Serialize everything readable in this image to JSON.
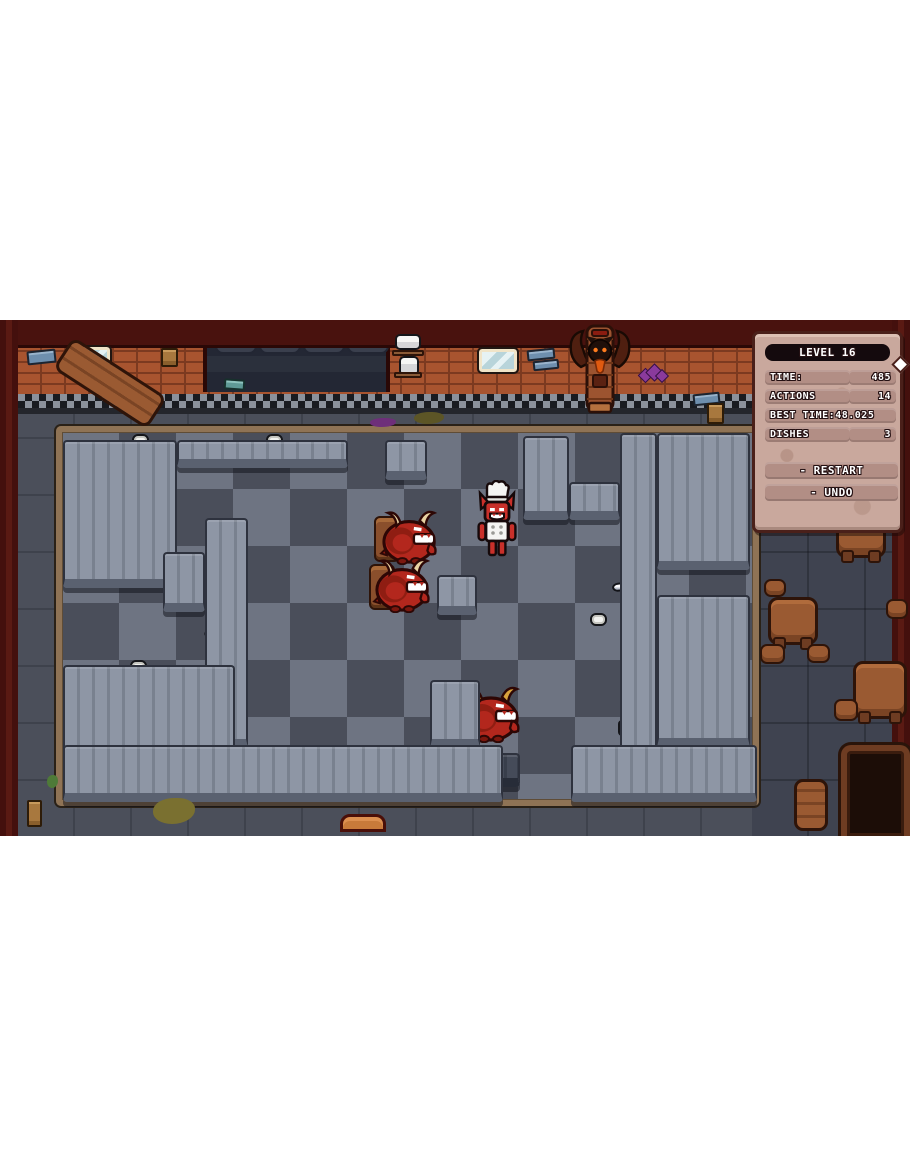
{
  "hud": {
    "level_label": "LEVEL 16",
    "rows": [
      {
        "label": "TIME:",
        "value": "485"
      },
      {
        "label": "ACTIONS",
        "value": "14"
      },
      {
        "label": "BEST TIME:",
        "value": "48.025",
        "wide": true
      },
      {
        "label": "DISHES",
        "value": "3"
      }
    ],
    "buttons": [
      {
        "label": "- RESTART",
        "name": "restart-button"
      },
      {
        "label": "- UNDO",
        "name": "undo-button"
      }
    ]
  },
  "colors": {
    "panel": "#c9a89d",
    "panel_pill": "#b28e85",
    "level_bar": "#140a0d",
    "counter": "#8e96a5",
    "kitchen_floor_dark": "#4a4e5a",
    "kitchen_floor_light": "#6e7482",
    "brick": "#a8542f",
    "wall_trim_dark": "#191b20",
    "wall_trim_light": "#8b919b",
    "demon_red": "#b3271d",
    "chef_red": "#c9302a",
    "wood": "#9a5a32",
    "accent_orange": "#e09434"
  },
  "scene": {
    "entities": [
      {
        "t": "counter",
        "x": 63,
        "y": 120,
        "w": 114,
        "h": 148
      },
      {
        "t": "counter",
        "x": 177,
        "y": 120,
        "w": 171,
        "h": 28
      },
      {
        "t": "counter",
        "x": 385,
        "y": 120,
        "w": 42,
        "h": 40
      },
      {
        "t": "counter",
        "x": 523,
        "y": 116,
        "w": 46,
        "h": 84
      },
      {
        "t": "counter",
        "x": 569,
        "y": 162,
        "w": 51,
        "h": 38
      },
      {
        "t": "counter",
        "x": 620,
        "y": 113,
        "w": 37,
        "h": 352
      },
      {
        "t": "counter",
        "x": 657,
        "y": 113,
        "w": 93,
        "h": 137
      },
      {
        "t": "counter",
        "x": 657,
        "y": 275,
        "w": 93,
        "h": 152
      },
      {
        "t": "counter",
        "x": 63,
        "y": 345,
        "w": 172,
        "h": 122
      },
      {
        "t": "counter",
        "x": 205,
        "y": 198,
        "w": 43,
        "h": 230
      },
      {
        "t": "counter",
        "x": 163,
        "y": 232,
        "w": 42,
        "h": 60
      },
      {
        "t": "counter",
        "x": 437,
        "y": 255,
        "w": 40,
        "h": 40
      },
      {
        "t": "counter",
        "x": 430,
        "y": 360,
        "w": 50,
        "h": 68
      },
      {
        "t": "counter",
        "x": 63,
        "y": 425,
        "w": 440,
        "h": 57
      },
      {
        "t": "counter",
        "x": 571,
        "y": 425,
        "w": 186,
        "h": 57
      },
      {
        "t": "counter",
        "x": 479,
        "y": 433,
        "w": 41,
        "h": 34,
        "v": "dark"
      },
      {
        "t": "hole",
        "x": 662,
        "y": 163,
        "w": 44,
        "h": 46
      },
      {
        "t": "hole",
        "x": 662,
        "y": 300,
        "w": 44,
        "h": 46
      },
      {
        "t": "hole",
        "x": 110,
        "y": 378,
        "w": 55,
        "h": 48
      },
      {
        "t": "knife",
        "x": 64,
        "y": 160,
        "r": -14
      },
      {
        "t": "knife",
        "x": 204,
        "y": 300,
        "r": -10
      },
      {
        "t": "knife",
        "x": 246,
        "y": 430,
        "r": -8
      },
      {
        "t": "knife",
        "x": 612,
        "y": 255,
        "r": -6
      },
      {
        "t": "plate",
        "x": 132,
        "y": 114
      },
      {
        "t": "plate",
        "x": 266,
        "y": 114
      },
      {
        "t": "plate",
        "x": 681,
        "y": 115
      },
      {
        "t": "plate",
        "x": 441,
        "y": 256
      },
      {
        "t": "plate",
        "x": 130,
        "y": 340
      },
      {
        "t": "plate",
        "x": 222,
        "y": 362
      },
      {
        "t": "plate",
        "x": 590,
        "y": 293
      },
      {
        "t": "plate",
        "x": 628,
        "y": 385
      },
      {
        "t": "plate",
        "x": 795,
        "y": 283
      },
      {
        "t": "cup",
        "x": 72,
        "y": 435
      },
      {
        "t": "cup",
        "x": 92,
        "y": 426
      },
      {
        "t": "cup",
        "x": 444,
        "y": 429
      },
      {
        "t": "cup",
        "x": 572,
        "y": 435
      },
      {
        "t": "cup",
        "x": 640,
        "y": 425
      },
      {
        "t": "cup",
        "x": 881,
        "y": 345,
        "v": "pink"
      },
      {
        "t": "cup",
        "x": 208,
        "y": 377,
        "v": "pink"
      },
      {
        "t": "cup",
        "x": 618,
        "y": 400,
        "v": "pink"
      },
      {
        "t": "food",
        "x": 777,
        "y": 296
      },
      {
        "t": "food",
        "x": 858,
        "y": 356
      },
      {
        "t": "food",
        "x": 882,
        "y": 365
      },
      {
        "t": "tray",
        "x": 853,
        "y": 210
      },
      {
        "t": "table",
        "x": 768,
        "y": 277,
        "w": 50,
        "h": 48
      },
      {
        "t": "table",
        "x": 836,
        "y": 200,
        "w": 50,
        "h": 38
      },
      {
        "t": "table",
        "x": 853,
        "y": 341,
        "w": 54,
        "h": 58
      },
      {
        "t": "stool",
        "x": 764,
        "y": 259,
        "w": 22,
        "h": 18
      },
      {
        "t": "stool",
        "x": 886,
        "y": 279,
        "w": 22,
        "h": 20
      },
      {
        "t": "stool",
        "x": 760,
        "y": 324,
        "w": 25,
        "h": 20
      },
      {
        "t": "stool",
        "x": 807,
        "y": 324,
        "w": 23,
        "h": 19
      },
      {
        "t": "stool",
        "x": 834,
        "y": 379,
        "w": 24,
        "h": 22
      },
      {
        "t": "chair",
        "x": 374,
        "y": 196,
        "w": 26,
        "h": 46
      },
      {
        "t": "chair",
        "x": 369,
        "y": 244,
        "w": 26,
        "h": 46
      },
      {
        "t": "chair",
        "x": 456,
        "y": 374,
        "w": 26,
        "h": 44
      },
      {
        "t": "demon",
        "x": 379,
        "y": 189,
        "w": 64,
        "h": 56
      },
      {
        "t": "demon",
        "x": 372,
        "y": 237,
        "w": 64,
        "h": 56
      },
      {
        "t": "demon",
        "x": 459,
        "y": 365,
        "w": 68,
        "h": 58,
        "v": "gold"
      },
      {
        "t": "chef",
        "x": 471,
        "y": 160,
        "w": 52,
        "h": 78
      },
      {
        "t": "statue",
        "x": 567,
        "y": 3,
        "w": 66,
        "h": 98
      },
      {
        "t": "bench",
        "x": 54,
        "y": 44,
        "w": 112,
        "h": 38,
        "r": 33
      },
      {
        "t": "bench",
        "x": 794,
        "y": 459,
        "w": 34,
        "h": 52
      },
      {
        "t": "bench",
        "x": 340,
        "y": 494,
        "w": 46,
        "h": 18,
        "v": "orange"
      },
      {
        "t": "doorway",
        "x": 841,
        "y": 425,
        "w": 69,
        "h": 91
      },
      {
        "t": "window",
        "x": 72,
        "y": 27,
        "w": 38,
        "h": 23
      },
      {
        "t": "window",
        "x": 479,
        "y": 29,
        "w": 38,
        "h": 23
      },
      {
        "t": "papers",
        "x": 27,
        "y": 30,
        "w": 29,
        "h": 14,
        "v": "blue"
      },
      {
        "t": "papers",
        "x": 527,
        "y": 29,
        "w": 28,
        "h": 11,
        "v": "blue"
      },
      {
        "t": "papers",
        "x": 533,
        "y": 40,
        "w": 26,
        "h": 10,
        "v": "blue"
      },
      {
        "t": "papers",
        "x": 693,
        "y": 73,
        "w": 27,
        "h": 12,
        "v": "blue"
      },
      {
        "t": "papers",
        "x": 224,
        "y": 59,
        "w": 21,
        "h": 11,
        "v": "teal"
      },
      {
        "t": "papers",
        "x": 161,
        "y": 28,
        "w": 17,
        "h": 19,
        "v": "brown"
      },
      {
        "t": "papers",
        "x": 707,
        "y": 83,
        "w": 17,
        "h": 21,
        "v": "brown"
      },
      {
        "t": "papers",
        "x": 27,
        "y": 480,
        "w": 15,
        "h": 27,
        "v": "brown"
      },
      {
        "t": "shelf",
        "x": 392,
        "y": 30,
        "w": 32,
        "h": 6
      },
      {
        "t": "shelf",
        "x": 394,
        "y": 52,
        "w": 28,
        "h": 6
      },
      {
        "t": "pot",
        "x": 395,
        "y": 14,
        "w": 26,
        "h": 16
      },
      {
        "t": "pot",
        "x": 399,
        "y": 36,
        "w": 20,
        "h": 20
      },
      {
        "t": "gems",
        "x": 638,
        "y": 44,
        "w": 28,
        "h": 18
      },
      {
        "t": "stain",
        "x": 153,
        "y": 478,
        "w": 42,
        "h": 26,
        "v": "#7a7030"
      },
      {
        "t": "stain",
        "x": 414,
        "y": 92,
        "w": 30,
        "h": 12,
        "v": "#5c5526"
      },
      {
        "t": "stain",
        "x": 876,
        "y": 84,
        "w": 24,
        "h": 15,
        "v": "#5c2a66"
      },
      {
        "t": "stain",
        "x": 370,
        "y": 98,
        "w": 26,
        "h": 9,
        "v": "#6e2f7a"
      },
      {
        "t": "stain",
        "x": 256,
        "y": 474,
        "w": 72,
        "h": 7,
        "v": "#6e2f7a"
      },
      {
        "t": "stain",
        "x": 47,
        "y": 455,
        "w": 11,
        "h": 13,
        "v": "#4e7a38"
      }
    ]
  }
}
